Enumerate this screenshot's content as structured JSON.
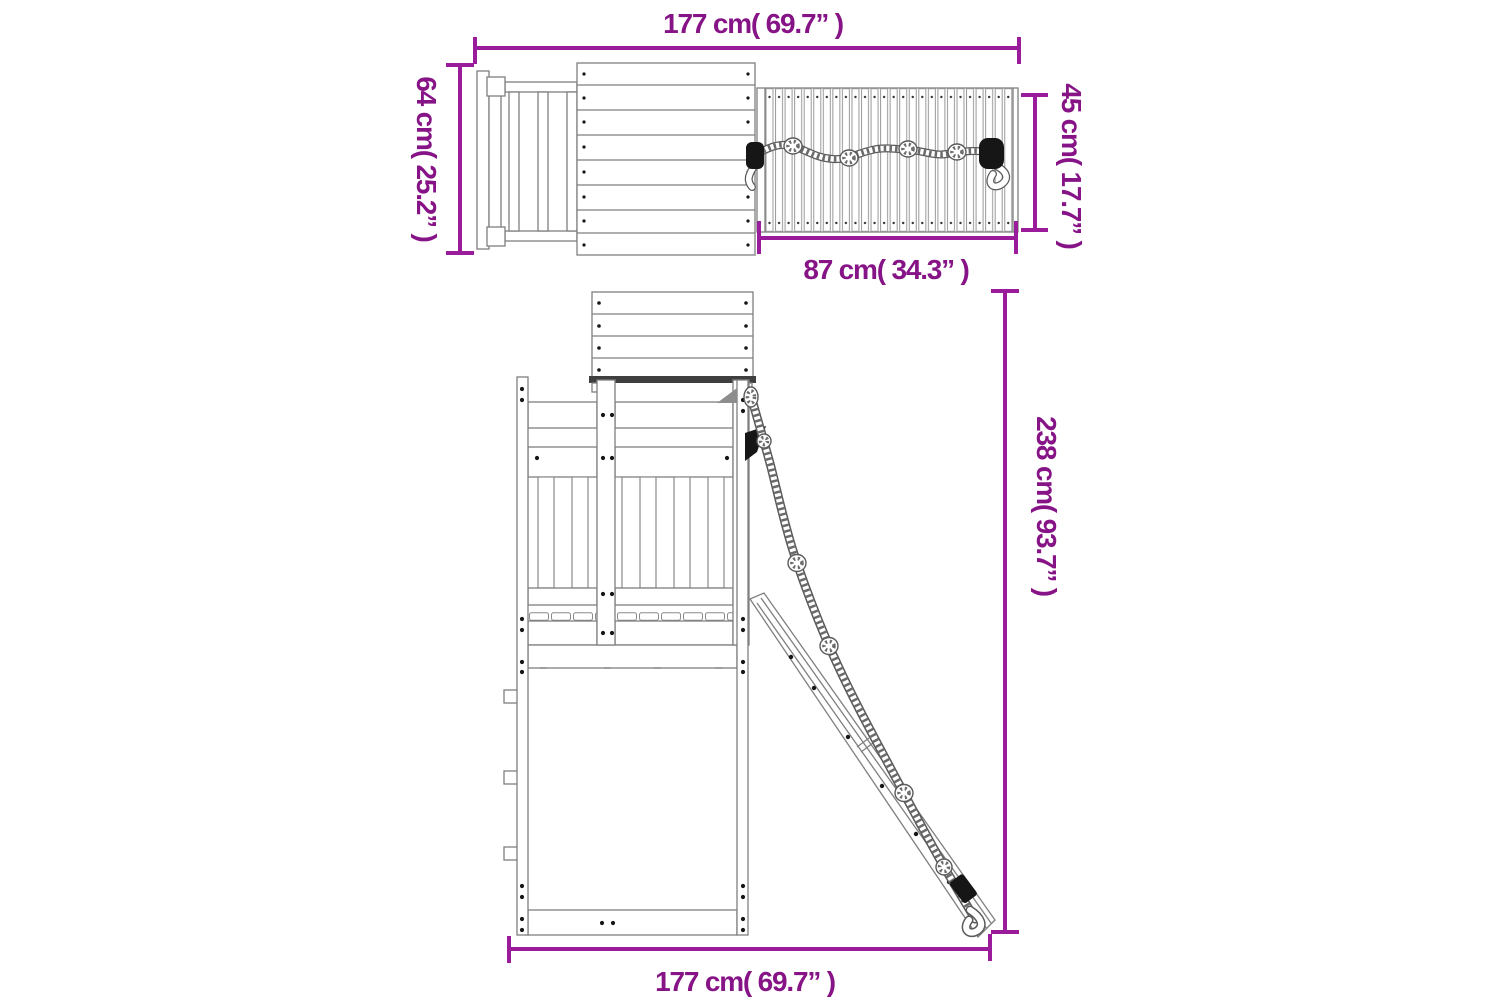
{
  "colors": {
    "dim": "#9A1C9A",
    "dim_text": "#871487",
    "line": "#7f7f7f",
    "dark": "#161616"
  },
  "dimensions": {
    "top_width": "177 cm( 69.7” )",
    "ladder_depth": "64 cm( 25.2” )",
    "climb_wall_height": "45 cm( 17.7” )",
    "climb_wall_width": "87 cm( 34.3” )",
    "total_height": "238 cm( 93.7” )",
    "base_width": "177 cm( 69.7” )"
  }
}
